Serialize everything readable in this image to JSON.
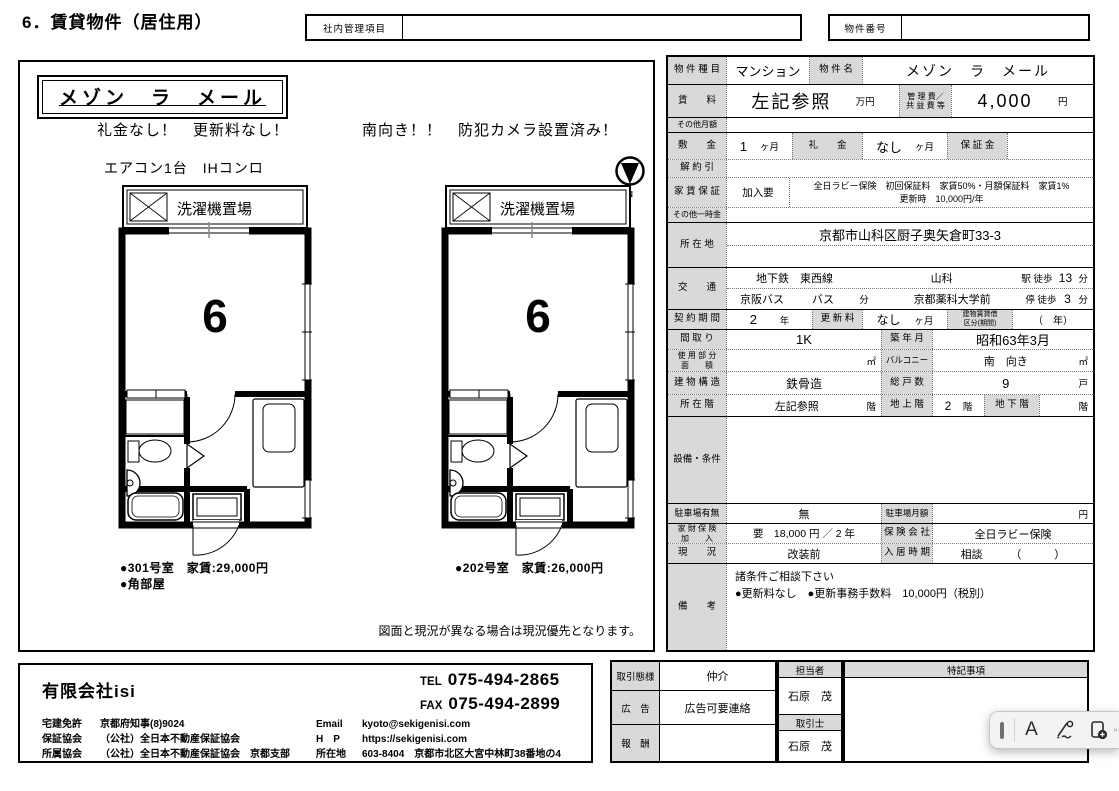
{
  "page": {
    "title": "6．賃貸物件（居住用）",
    "internal_label": "社内管理項目",
    "internal_value": "",
    "propno_label": "物件番号",
    "propno_value": ""
  },
  "flyer": {
    "name": "メゾン　ラ　メール",
    "hl1a": "礼金なし！　更新料なし！",
    "hl1b": "南向き！！　防犯カメラ設置済み！",
    "hl2": "エアコン1台　IHコンロ",
    "compass_n": "N",
    "plans": [
      {
        "balcony": "洗濯機置場",
        "room": "6",
        "cap1": "●301号室　家賃:29,000円",
        "cap2": "●角部屋"
      },
      {
        "balcony": "洗濯機置場",
        "room": "6",
        "cap1": "●202号室　家賃:26,000円",
        "cap2": ""
      }
    ],
    "disclaimer": "図面と現況が異なる場合は現況優先となります。"
  },
  "spec": {
    "r1": {
      "l1": "物 件 種 目",
      "v1": "マンション",
      "l2": "物 件 名",
      "v2": "メゾン　ラ　メール"
    },
    "r2": {
      "l1": "賃　　料",
      "v1": "左記参照",
      "u1": "万円",
      "l2": "管 理 費／\n共 益 費 等",
      "v2": "4,000",
      "u2": "円"
    },
    "r3": {
      "l1": "その他月額",
      "v1": ""
    },
    "r4": {
      "l1": "敷　　金",
      "v1": "1",
      "u1": "ヶ月",
      "l2": "礼　　金",
      "v2": "なし",
      "u2": "ヶ月",
      "l3": "保 証 金",
      "v3": ""
    },
    "r5": {
      "l1": "解 約 引",
      "v1": ""
    },
    "r6": {
      "l1": "家 賃 保 証",
      "v1": "加入要",
      "v2": "全日ラビー保険　初回保証料　家賃50%・月額保証料　家賃1%\n更新時　10,000円/年"
    },
    "r7": {
      "l1": "その他一時金",
      "v1": ""
    },
    "r8": {
      "l1": "所 在 地",
      "v1": "京都市山科区厨子奥矢倉町33-3"
    },
    "r9": {
      "l1": "交　　通",
      "t1": "地下鉄　東西線",
      "t2": "山科",
      "t3": "駅 徒歩",
      "t4": "13",
      "t5": "分",
      "b1": "京阪バス",
      "b2": "バス",
      "b3": "分",
      "b4": "京都薬科大学前",
      "b5": "停 徒歩",
      "b6": "3",
      "b7": "分"
    },
    "r10": {
      "l1": "契 約 期 間",
      "v1": "2",
      "u1": "年",
      "l2": "更 新 料",
      "v2": "なし",
      "u2": "ヶ月",
      "l3": "建物賃貸借\n区分(期間)",
      "v3": "（　年）"
    },
    "r11": {
      "l1": "間 取 り",
      "v1": "1K",
      "l2": "築 年 月",
      "v2": "昭和63年3月"
    },
    "r12": {
      "l1": "使 用 部 分\n面　　積",
      "u1": "㎡",
      "l2": "バルコニー",
      "v2": "南　向き",
      "u2": "㎡"
    },
    "r13": {
      "l1": "建 物 構 造",
      "v1": "鉄骨造",
      "l2": "総 戸 数",
      "v2": "9",
      "u2": "戸"
    },
    "r14": {
      "l1": "所 在 階",
      "v1": "左記参照",
      "u1": "階",
      "l2": "地 上 階",
      "v2": "2",
      "u2": "階",
      "l3": "地 下 階",
      "v3": "",
      "u3": "階"
    },
    "r15": {
      "l1": "設備・条件",
      "v1": ""
    },
    "r16": {
      "l1": "駐車場有無",
      "v1": "無",
      "l2": "駐車場月額",
      "v2": "",
      "u2": "円"
    },
    "r17": {
      "l1": "家 財 保 険\n加　　入",
      "v1": "要　18,000 円 ／ 2 年",
      "l2": "保 険 会 社",
      "v2": "全日ラビー保険"
    },
    "r18": {
      "l1": "現　　況",
      "v1": "改装前",
      "l2": "入 居 時 期",
      "v2": "相談",
      "u2": "（　　　）"
    },
    "r19": {
      "l1": "備　　考",
      "v1": "諸条件ご相談下さい\n●更新料なし　●更新事務手数料　10,000円（税別）"
    }
  },
  "footer": {
    "company": {
      "name": "有限会社isi",
      "tel_label": "TEL",
      "tel": "075-494-2865",
      "fax_label": "FAX",
      "fax": "075-494-2899",
      "lic1a": "宅建免許",
      "lic1b": "京都府知事(8)9024",
      "lic2a": "保証協会",
      "lic2b": "（公社）全日本不動産保証協会",
      "lic3a": "所属協会",
      "lic3b": "（公社）全日本不動産保証協会　京都支部",
      "c1a": "Email",
      "c1b": "kyoto@sekigenisi.com",
      "c2a": "H　P",
      "c2b": "https://sekigenisi.com",
      "c3a": "所在地",
      "c3b": "603-8404　京都市北区大宮中林町38番地の4"
    },
    "deal": {
      "l1": "取引態様",
      "v1": "仲介",
      "l2": "広　告",
      "v2": "広告可要連絡",
      "l3": "報　酬",
      "v3": "",
      "sh1": "担当者",
      "sv1": "石原　茂",
      "sh2": "取引士",
      "sv2": "石原　茂",
      "nh": "特記事項",
      "nv": ""
    }
  },
  "toolbar": {
    "icons": [
      "text-cursor",
      "text-annotation",
      "signature",
      "add-from-device",
      "more"
    ]
  }
}
